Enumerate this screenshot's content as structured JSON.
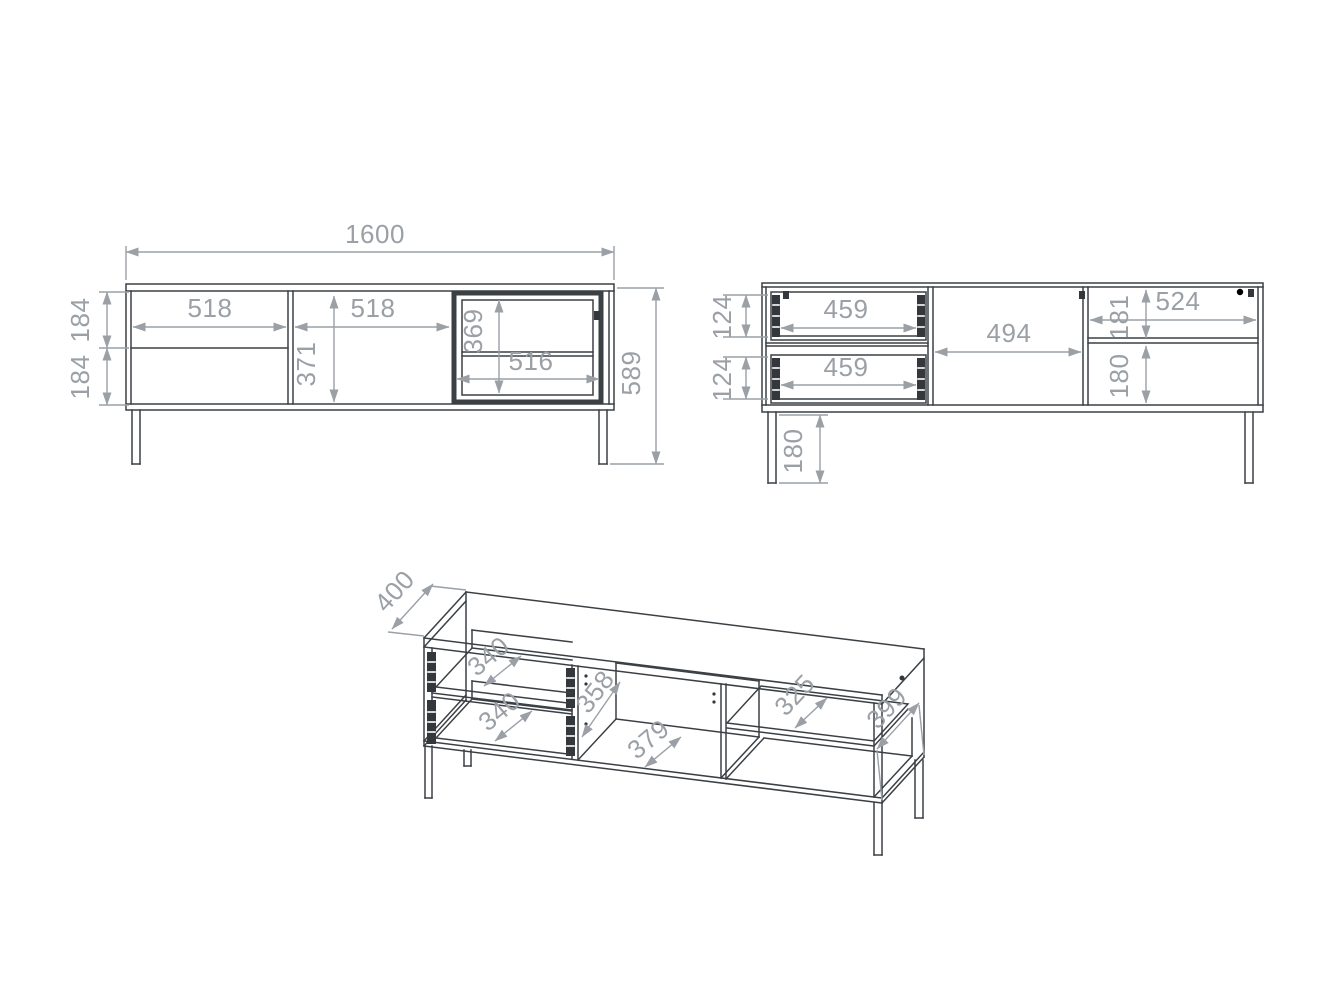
{
  "drawing_title": "TV stand technical drawing, three views with millimetre dimensions",
  "front_view": {
    "name": "front elevation (closed)",
    "dims": {
      "width_total": "1600",
      "height_total": "589",
      "left_section_width": "518",
      "middle_door_width": "518",
      "middle_door_height": "371",
      "drawer_front_top_height": "184",
      "drawer_front_bottom_height": "184",
      "glass_opening_height": "369",
      "glass_opening_width": "516"
    }
  },
  "interior_view": {
    "name": "front elevation (interior / fronts removed)",
    "dims": {
      "drawer_top_width": "459",
      "drawer_bottom_width": "459",
      "drawer_top_side_height": "124",
      "drawer_bottom_side_height": "124",
      "middle_opening_width": "494",
      "right_section_width": "524",
      "right_above_shelf_height": "181",
      "right_below_shelf_height": "180",
      "leg_height": "180"
    }
  },
  "perspective_view": {
    "name": "axonometric view",
    "dims": {
      "depth_total": "400",
      "drawer_top_depth": "340",
      "drawer_bottom_depth": "340",
      "middle_opening_height": "358",
      "middle_opening_depth": "379",
      "shelf_depth": "325",
      "side_panel_depth": "399"
    }
  },
  "colors": {
    "outline": "#3b4045",
    "dimension": "#9aa0a6",
    "background": "#ffffff"
  }
}
